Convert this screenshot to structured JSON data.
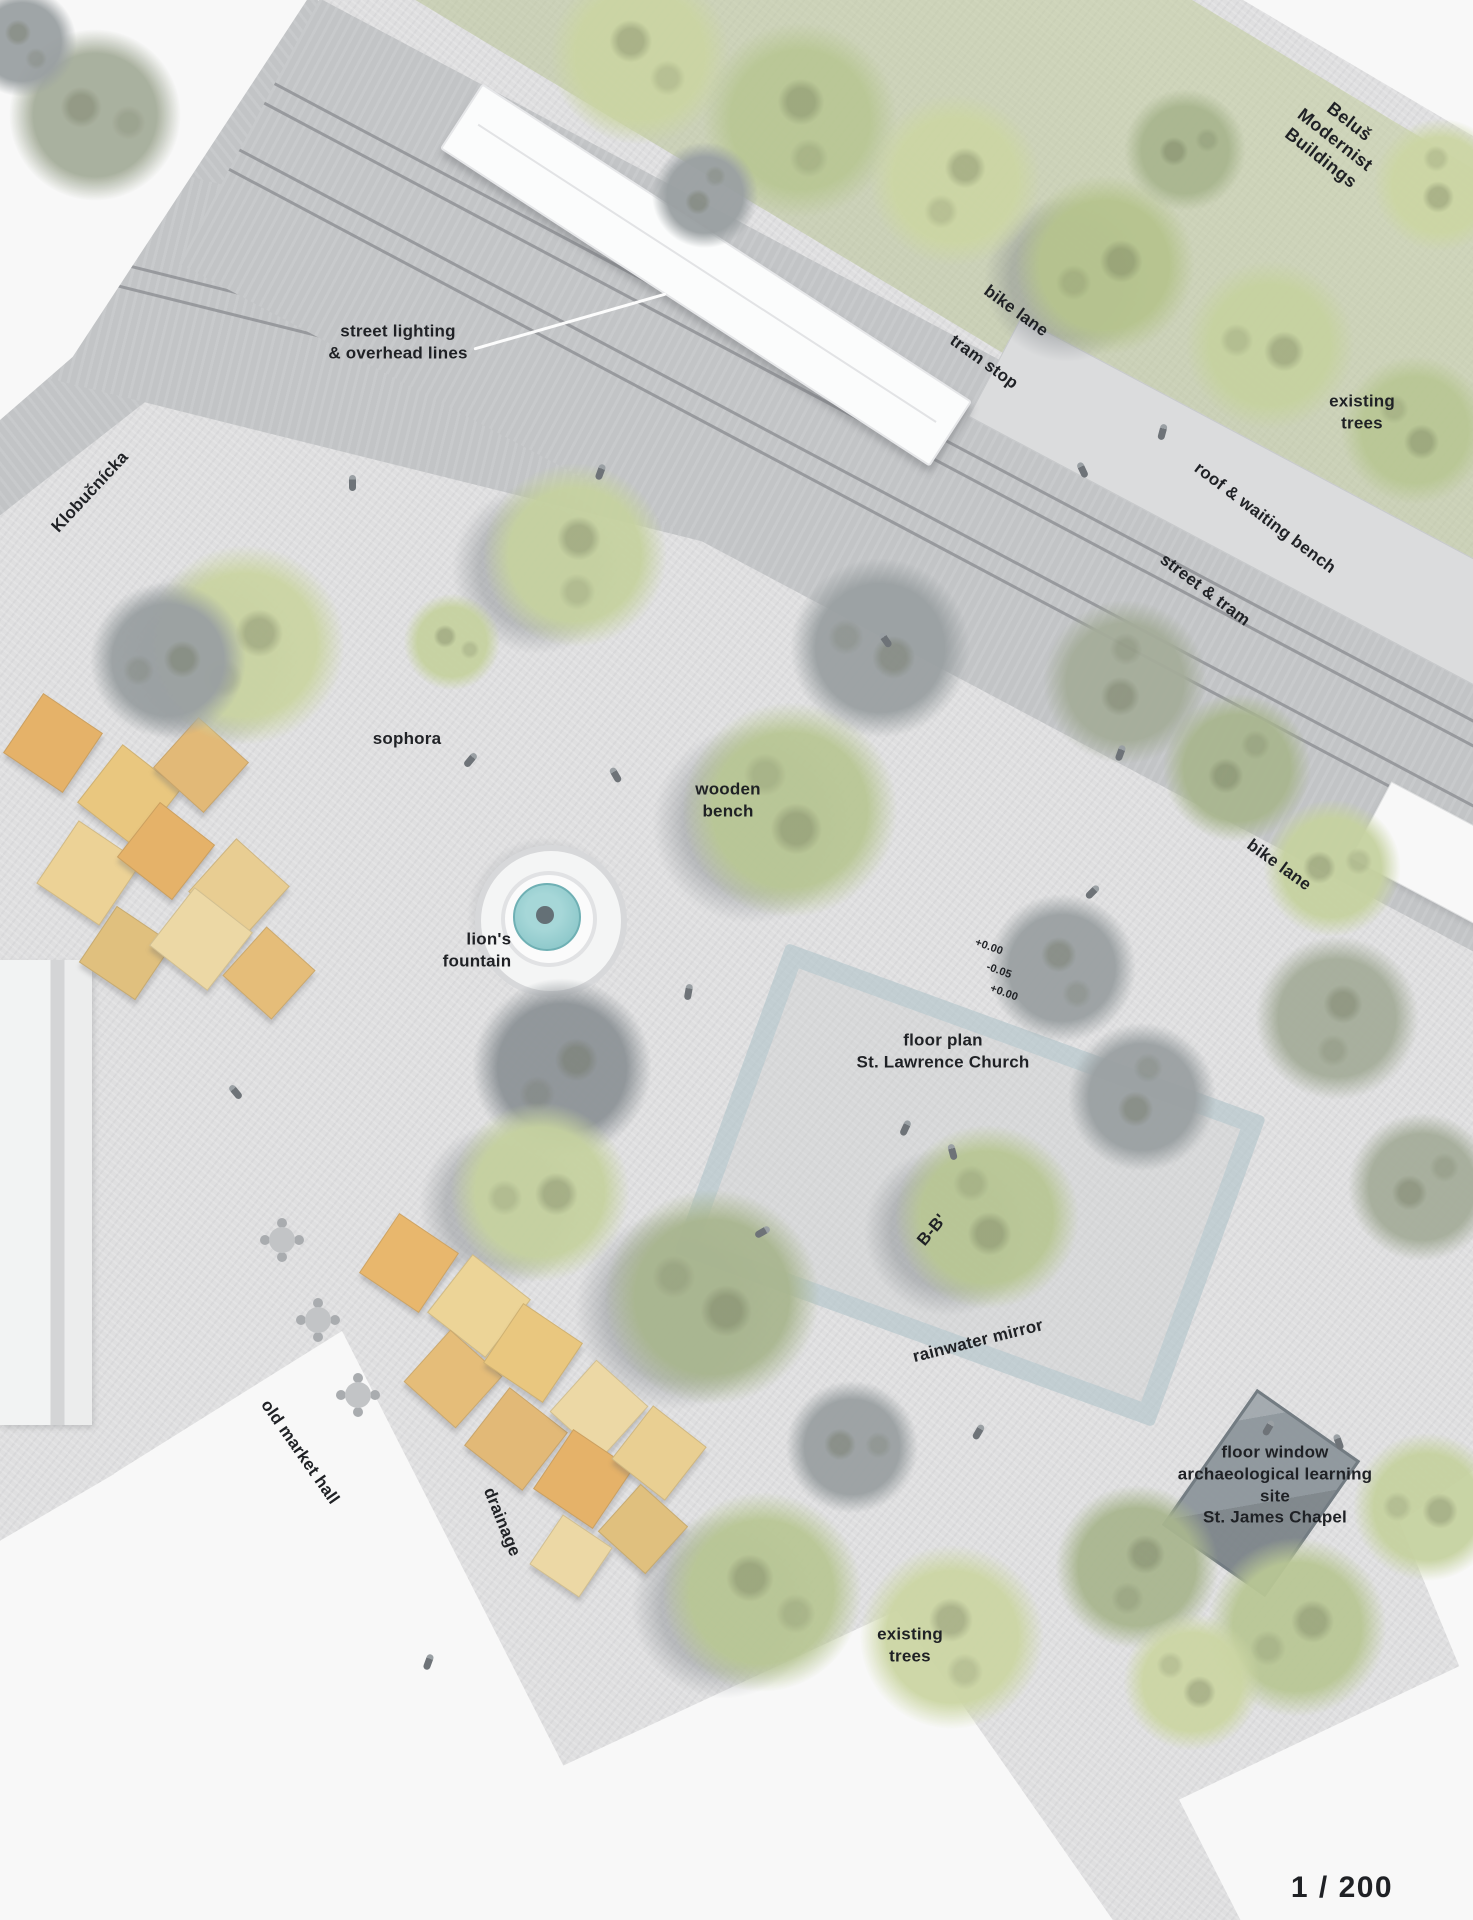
{
  "plan": {
    "type": "architectural site plan",
    "scale": "1 / 200"
  },
  "labels": {
    "belus": {
      "text": "Beluš Modernist Buildings"
    },
    "bike_lane_top": {
      "text": "bike lane"
    },
    "tram_stop": {
      "text": "tram stop"
    },
    "street_lighting": {
      "text": "street lighting\n& overhead lines"
    },
    "existing_trees_top": {
      "text": "existing\ntrees"
    },
    "klobucnicka": {
      "text": "Klobučnícka"
    },
    "roof_waiting_bench": {
      "text": "roof & waiting bench"
    },
    "street_tram": {
      "text": "street & tram"
    },
    "sophora": {
      "text": "sophora"
    },
    "wooden_bench": {
      "text": "wooden\nbench"
    },
    "bike_lane_right": {
      "text": "bike lane"
    },
    "lions_fountain": {
      "text": "lion's\nfountain"
    },
    "elev_top": {
      "text": "+0.00"
    },
    "elev_mid": {
      "text": "-0.05"
    },
    "elev_bottom": {
      "text": "+0.00"
    },
    "church": {
      "text": "floor plan\nSt. Lawrence Church"
    },
    "section_bb": {
      "text": "B-B'"
    },
    "rainwater_mirror": {
      "text": "rainwater mirror"
    },
    "old_market_hall": {
      "text": "old market hall"
    },
    "drainage": {
      "text": "drainage"
    },
    "floor_window": {
      "text": "floor window\narchaeological learning site\nSt. James Chapel"
    },
    "existing_trees_bottom": {
      "text": "existing\ntrees"
    },
    "scale": {
      "text": "1 / 200"
    }
  },
  "colors": {
    "plaza": "#dfdfe0",
    "street": "#c2c4c6",
    "track": "#8f9295",
    "building": "#f8f8f8",
    "tree_green_light": "#ccd6a4",
    "tree_green_mid": "#b9c795",
    "tree_gray": "#9aa0a2",
    "stall_orange": "#e5b269",
    "stall_tan": "#ecd497",
    "fountain_water": "#8fc8ca",
    "mirror_blue": "#afc4cc",
    "floor_window_gray": "#8b949a",
    "label_text": "#1f2125"
  },
  "scene": {
    "trees": [
      {
        "x": 640,
        "y": 55,
        "r": 115,
        "c": "#cbd5a3"
      },
      {
        "x": 800,
        "y": 120,
        "r": 125,
        "c": "#b9c795"
      },
      {
        "x": 955,
        "y": 180,
        "r": 110,
        "c": "#ccd6a4"
      },
      {
        "x": 1105,
        "y": 265,
        "r": 115,
        "c": "#b6c48e",
        "s": 1
      },
      {
        "x": 1270,
        "y": 345,
        "r": 108,
        "c": "#c6d2a0"
      },
      {
        "x": 1415,
        "y": 430,
        "r": 95,
        "c": "#b9c795"
      },
      {
        "x": 1440,
        "y": 185,
        "r": 85,
        "c": "#ccd6a4"
      },
      {
        "x": 705,
        "y": 195,
        "r": 68,
        "c": "#9aa0a2"
      },
      {
        "x": 1185,
        "y": 150,
        "r": 78,
        "c": "#a9b68f"
      },
      {
        "x": 95,
        "y": 115,
        "r": 110,
        "c": "#a5ad9a"
      },
      {
        "x": 22,
        "y": 42,
        "r": 70,
        "c": "#9aa0a2"
      },
      {
        "x": 575,
        "y": 555,
        "r": 118,
        "c": "#c6d2a0",
        "s": 1
      },
      {
        "x": 245,
        "y": 645,
        "r": 128,
        "c": "#cbd5a3",
        "s": 1
      },
      {
        "x": 168,
        "y": 660,
        "r": 100,
        "c": "#9aa0a2"
      },
      {
        "x": 880,
        "y": 648,
        "r": 115,
        "c": "#9aa0a2"
      },
      {
        "x": 790,
        "y": 810,
        "r": 138,
        "c": "#b9c795",
        "s": 1
      },
      {
        "x": 1125,
        "y": 682,
        "r": 105,
        "c": "#a5ad9a"
      },
      {
        "x": 1237,
        "y": 768,
        "r": 95,
        "c": "#a9b68f"
      },
      {
        "x": 1332,
        "y": 868,
        "r": 88,
        "c": "#c6d2a0"
      },
      {
        "x": 452,
        "y": 642,
        "r": 62,
        "c": "#c6d2a0"
      },
      {
        "x": 1062,
        "y": 968,
        "r": 95,
        "c": "#9aa0a2"
      },
      {
        "x": 1337,
        "y": 1018,
        "r": 105,
        "c": "#a5ad9a"
      },
      {
        "x": 562,
        "y": 1068,
        "r": 115,
        "c": "#8d9397"
      },
      {
        "x": 540,
        "y": 1192,
        "r": 115,
        "c": "#c6d2a0",
        "s": 1
      },
      {
        "x": 712,
        "y": 1297,
        "r": 138,
        "c": "#a9b68f",
        "s": 1
      },
      {
        "x": 987,
        "y": 1217,
        "r": 118,
        "c": "#b9c795",
        "s": 1
      },
      {
        "x": 1142,
        "y": 1097,
        "r": 95,
        "c": "#9aa0a2"
      },
      {
        "x": 1422,
        "y": 1187,
        "r": 95,
        "c": "#a5ad9a"
      },
      {
        "x": 852,
        "y": 1447,
        "r": 85,
        "c": "#9aa0a2"
      },
      {
        "x": 762,
        "y": 1592,
        "r": 128,
        "c": "#b9c795",
        "s": 1
      },
      {
        "x": 952,
        "y": 1637,
        "r": 118,
        "c": "#ccd6a4"
      },
      {
        "x": 1137,
        "y": 1567,
        "r": 105,
        "c": "#a9b68f"
      },
      {
        "x": 1297,
        "y": 1627,
        "r": 115,
        "c": "#b9c795"
      },
      {
        "x": 1427,
        "y": 1507,
        "r": 95,
        "c": "#c6d2a0"
      },
      {
        "x": 1192,
        "y": 1682,
        "r": 88,
        "c": "#ccd6a4"
      }
    ],
    "stalls": [
      {
        "x": 52,
        "y": 742,
        "w": 70,
        "c": "#e5b269"
      },
      {
        "x": 128,
        "y": 795,
        "w": 72,
        "c": "#e9c77f"
      },
      {
        "x": 200,
        "y": 764,
        "w": 66,
        "c": "#e2b977"
      },
      {
        "x": 88,
        "y": 872,
        "w": 74,
        "c": "#ecd296"
      },
      {
        "x": 165,
        "y": 850,
        "w": 68,
        "c": "#e5b269"
      },
      {
        "x": 238,
        "y": 888,
        "w": 70,
        "c": "#e8cd92"
      },
      {
        "x": 125,
        "y": 952,
        "w": 66,
        "c": "#e0c07e"
      },
      {
        "x": 200,
        "y": 938,
        "w": 72,
        "c": "#ecd8a5"
      },
      {
        "x": 268,
        "y": 972,
        "w": 64,
        "c": "#e5bd79"
      },
      {
        "x": 408,
        "y": 1262,
        "w": 70,
        "c": "#e8b76d"
      },
      {
        "x": 478,
        "y": 1305,
        "w": 72,
        "c": "#ecd497"
      },
      {
        "x": 452,
        "y": 1378,
        "w": 68,
        "c": "#e5bd79"
      },
      {
        "x": 532,
        "y": 1352,
        "w": 70,
        "c": "#e9c77f"
      },
      {
        "x": 515,
        "y": 1438,
        "w": 72,
        "c": "#e2b977"
      },
      {
        "x": 598,
        "y": 1408,
        "w": 68,
        "c": "#ecd8a5"
      },
      {
        "x": 582,
        "y": 1478,
        "w": 70,
        "c": "#e5b269"
      },
      {
        "x": 658,
        "y": 1452,
        "w": 66,
        "c": "#e9cf92"
      },
      {
        "x": 642,
        "y": 1528,
        "w": 62,
        "c": "#e0c07e"
      },
      {
        "x": 570,
        "y": 1555,
        "w": 58,
        "c": "#ecd8a5"
      }
    ],
    "tables": [
      {
        "x": 318,
        "y": 1320
      },
      {
        "x": 358,
        "y": 1395
      },
      {
        "x": 282,
        "y": 1240
      }
    ],
    "people": [
      {
        "x": 470,
        "y": 760,
        "a": 40
      },
      {
        "x": 615,
        "y": 775,
        "a": -30
      },
      {
        "x": 688,
        "y": 992,
        "a": 10
      },
      {
        "x": 905,
        "y": 1128,
        "a": 25
      },
      {
        "x": 952,
        "y": 1152,
        "a": -15
      },
      {
        "x": 762,
        "y": 1232,
        "a": 60
      },
      {
        "x": 978,
        "y": 1432,
        "a": 30
      },
      {
        "x": 600,
        "y": 472,
        "a": 20
      },
      {
        "x": 1082,
        "y": 470,
        "a": -25
      },
      {
        "x": 1162,
        "y": 432,
        "a": 15
      },
      {
        "x": 352,
        "y": 483,
        "a": 0
      },
      {
        "x": 235,
        "y": 1092,
        "a": -40
      },
      {
        "x": 428,
        "y": 1662,
        "a": 20
      },
      {
        "x": 1268,
        "y": 1428,
        "a": 30
      },
      {
        "x": 1338,
        "y": 1442,
        "a": -20
      },
      {
        "x": 1092,
        "y": 892,
        "a": 45
      },
      {
        "x": 885,
        "y": 640,
        "a": -35
      },
      {
        "x": 1120,
        "y": 753,
        "a": 20
      }
    ]
  }
}
